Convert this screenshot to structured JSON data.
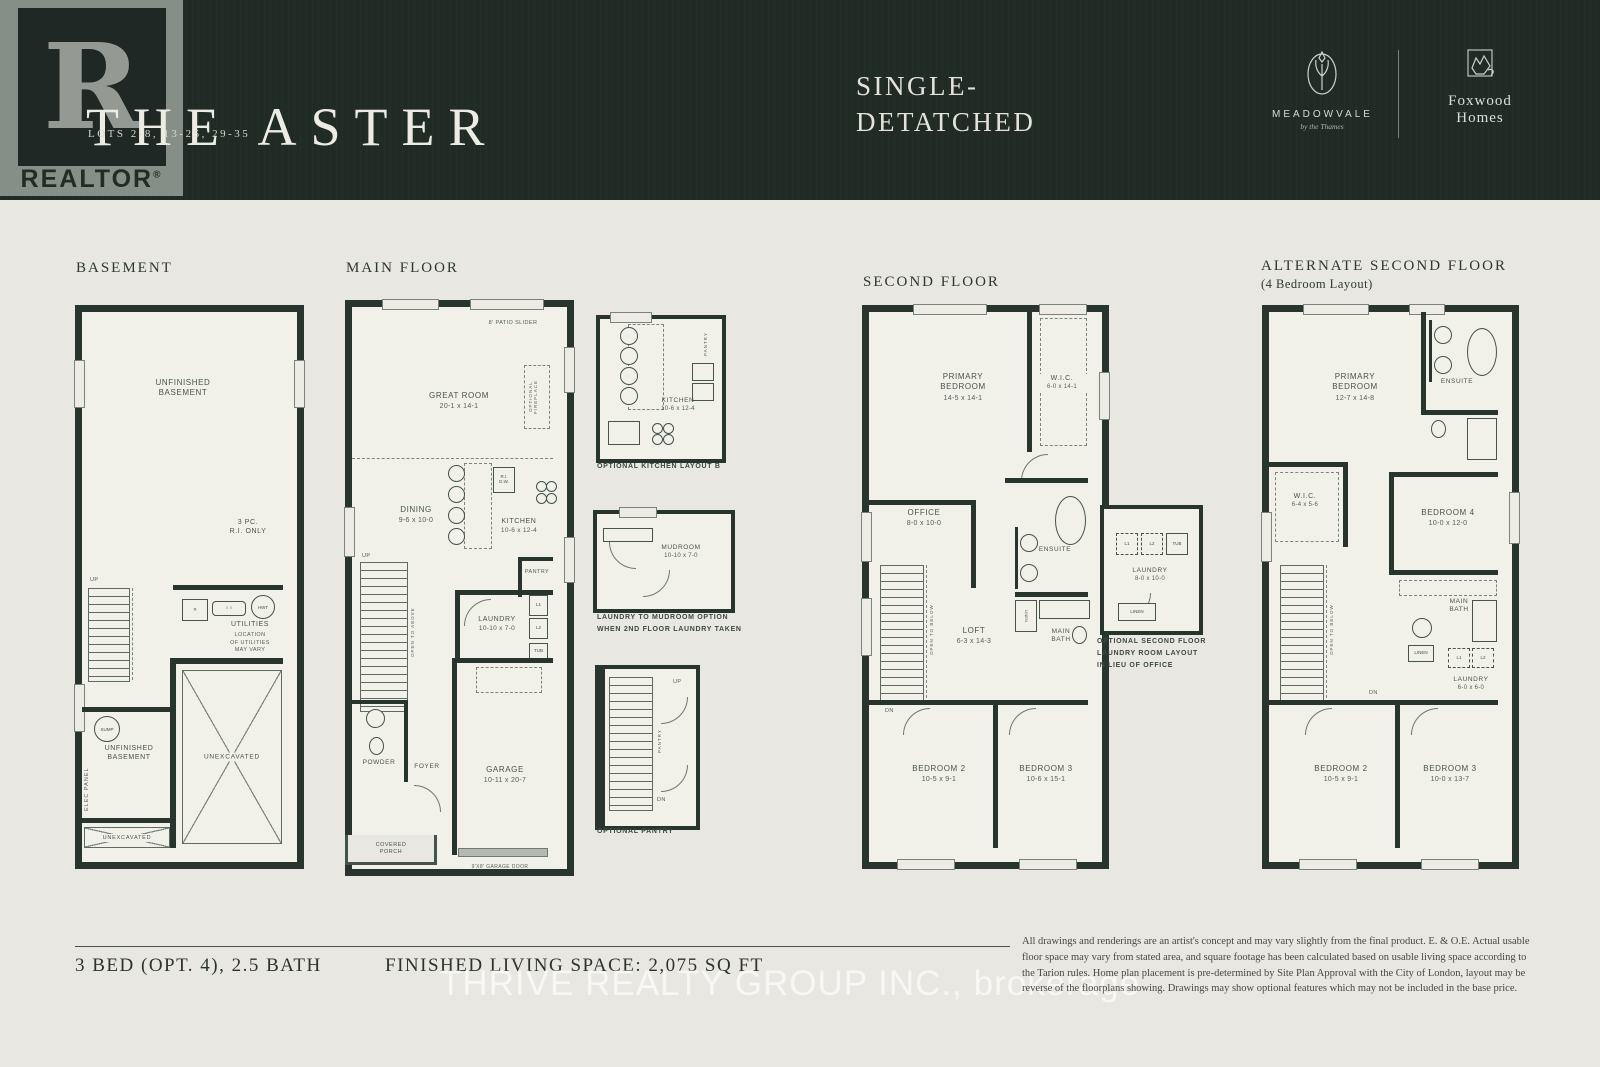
{
  "header": {
    "title": "THE ASTER",
    "lots": "LOTS 2-8, 13-25, 29-35",
    "type_line1": "SINGLE-",
    "type_line2": "DETATCHED",
    "realtor_r": "R",
    "realtor_word": "REALTOR",
    "realtor_reg": "®",
    "meadowvale": "MEADOWVALE",
    "meadowvale_tagline": "by the Thames",
    "foxwood_line1": "Foxwood",
    "foxwood_line2": "Homes"
  },
  "basement": {
    "heading": "BASEMENT",
    "unfinished_upper": "UNFINISHED\nBASEMENT",
    "rough_in": "3 PC.\nR.I. ONLY",
    "up": "UP",
    "utilities": "UTILITIES",
    "utilities_note": "LOCATION\nOF UTILITIES\nMAY VARY",
    "hwt": "HWT",
    "sump": "SUMP",
    "unfinished_lower": "UNFINISHED\nBASEMENT",
    "elec_panel": "ELEC PANEL",
    "unexcavated_large": "UNEXCAVATED",
    "unexcavated_small": "UNEXCAVATED"
  },
  "main_floor": {
    "heading": "MAIN FLOOR",
    "patio_slider": "8' PATIO SLIDER",
    "great_room": "GREAT ROOM",
    "great_room_dim": "20-1 x 14-1",
    "optional_fireplace": "OPTIONAL FIREPLACE",
    "dining": "DINING",
    "dining_dim": "9-6 x 10-0",
    "kitchen": "KITCHEN",
    "kitchen_dim": "10-6 x 12-4",
    "ri_dw": "R.I.\nD.W.",
    "pantry": "PANTRY",
    "laundry": "LAUNDRY",
    "laundry_dim": "10-10 x 7-0",
    "l1": "L1",
    "l2": "L2",
    "tub": "TUB",
    "open_to_above": "OPEN TO ABOVE",
    "up": "UP",
    "powder": "POWDER",
    "foyer": "FOYER",
    "garage": "GARAGE",
    "garage_dim": "10-11 x 20-7",
    "covered_porch": "COVERED\nPORCH",
    "garage_door": "9'X8' GARAGE DOOR"
  },
  "kitchen_b": {
    "caption": "OPTIONAL KITCHEN LAYOUT B",
    "kitchen": "KITCHEN",
    "kitchen_dim": "10-6 x 12-4",
    "pantry": "PANTRY"
  },
  "mudroom_opt": {
    "mudroom": "MUDROOM",
    "mudroom_dim": "10-10 x 7-0",
    "caption_line1": "LAUNDRY TO MUDROOM OPTION",
    "caption_line2": "WHEN 2ND FLOOR LAUNDRY TAKEN"
  },
  "pantry_opt": {
    "caption": "OPTIONAL PANTRY",
    "pantry": "PANTRY",
    "up": "UP",
    "dn": "DN"
  },
  "second_floor": {
    "heading": "SECOND FLOOR",
    "primary_bedroom": "PRIMARY\nBEDROOM",
    "primary_bedroom_dim": "14-5 x 14-1",
    "wic": "W.I.C.",
    "wic_dim": "6-0 x 14-1",
    "office": "OFFICE",
    "office_dim": "8-0 x 10-0",
    "ensuite": "ENSUITE",
    "loft": "LOFT",
    "loft_dim": "6-3 x 14-3",
    "linen": "LINEN",
    "main_bath": "MAIN\nBATH",
    "open_to_below": "OPEN TO BELOW",
    "dn": "DN",
    "bedroom2": "BEDROOM 2",
    "bedroom2_dim": "10-5 x 9-1",
    "bedroom3": "BEDROOM 3",
    "bedroom3_dim": "10-6 x 15-1"
  },
  "laundry_opt": {
    "caption_line1": "OPTIONAL SECOND FLOOR",
    "caption_line2": "LAUNDRY ROOM LAYOUT",
    "caption_line3": "IN LIEU OF OFFICE",
    "laundry": "LAUNDRY",
    "laundry_dim": "8-0 x 10-0",
    "l1": "L1",
    "l2": "L2",
    "tub": "TUB",
    "linen": "LINEN"
  },
  "alt_second": {
    "heading": "ALTERNATE SECOND FLOOR",
    "subheading": "(4 Bedroom Layout)",
    "primary_bedroom": "PRIMARY\nBEDROOM",
    "primary_bedroom_dim": "12-7 x 14-8",
    "ensuite": "ENSUITE",
    "wic": "W.I.C.",
    "wic_dim": "6-4 x 5-6",
    "bedroom4": "BEDROOM 4",
    "bedroom4_dim": "10-0 x 12-0",
    "main_bath": "MAIN\nBATH",
    "linen": "LINEN",
    "l1": "L1",
    "l2": "L2",
    "laundry": "LAUNDRY",
    "laundry_dim": "6-0 x 6-0",
    "open_to_below": "OPEN TO BELOW",
    "dn": "DN",
    "bedroom2": "BEDROOM 2",
    "bedroom2_dim": "10-5 x 9-1",
    "bedroom3": "BEDROOM 3",
    "bedroom3_dim": "10-0 x 13-7"
  },
  "footer": {
    "beds": "3 BED (OPT. 4), 2.5 BATH",
    "living_space": "FINISHED LIVING SPACE: 2,075 SQ FT",
    "watermark": "THRIVE REALTY GROUP INC., brokerage",
    "disclaimer": "All drawings and renderings are an artist's concept and may vary slightly from the final product. E. & O.E. Actual usable floor space may vary from stated area, and square footage has been calculated based on usable living space according to the Tarion rules. Home plan placement is pre-determined by Site Plan Approval with the City of London, layout may be reverse of the floorplans showing. Drawings may show optional features which may not be included in the base price."
  }
}
